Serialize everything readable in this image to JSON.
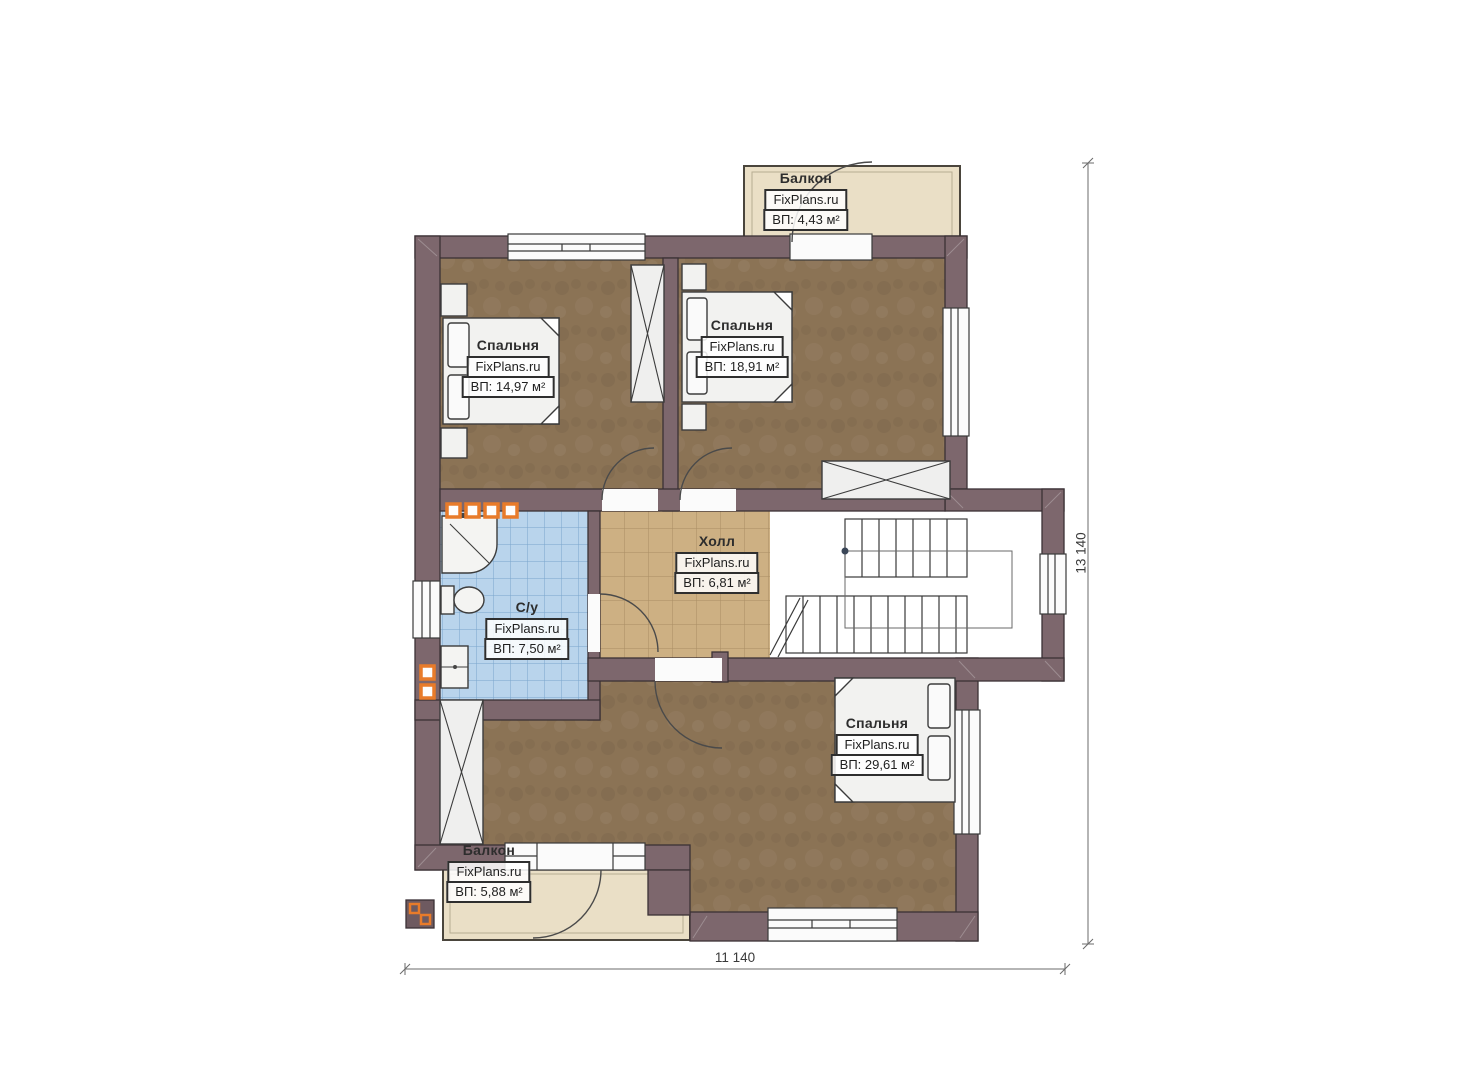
{
  "plan": {
    "watermark": "FixPlans.ru",
    "rooms": [
      {
        "id": "balcony-top",
        "name": "Балкон",
        "area": "ВП: 4,43 м²"
      },
      {
        "id": "bedroom-1",
        "name": "Спальня",
        "area": "ВП: 14,97 м²"
      },
      {
        "id": "bedroom-2",
        "name": "Спальня",
        "area": "ВП: 18,91 м²"
      },
      {
        "id": "hall",
        "name": "Холл",
        "area": "ВП: 6,81 м²"
      },
      {
        "id": "bathroom",
        "name": "С/у",
        "area": "ВП: 7,50 м²"
      },
      {
        "id": "bedroom-3",
        "name": "Спальня",
        "area": "ВП: 29,61 м²"
      },
      {
        "id": "balcony-bottom",
        "name": "Балкон",
        "area": "ВП: 5,88 м²"
      }
    ],
    "dimensions": {
      "width_label": "11 140",
      "height_label": "13 140"
    },
    "colors": {
      "wall": "#7d676d",
      "wall_outline": "#3b3135",
      "bedroom_floor": "#8b7355",
      "hall_floor": "#cdb083",
      "bathroom_floor": "#b9d4ec",
      "balcony_floor": "#eadfc6",
      "fixture_white": "#f2f2f0",
      "accent_orange": "#e87b2a"
    }
  }
}
